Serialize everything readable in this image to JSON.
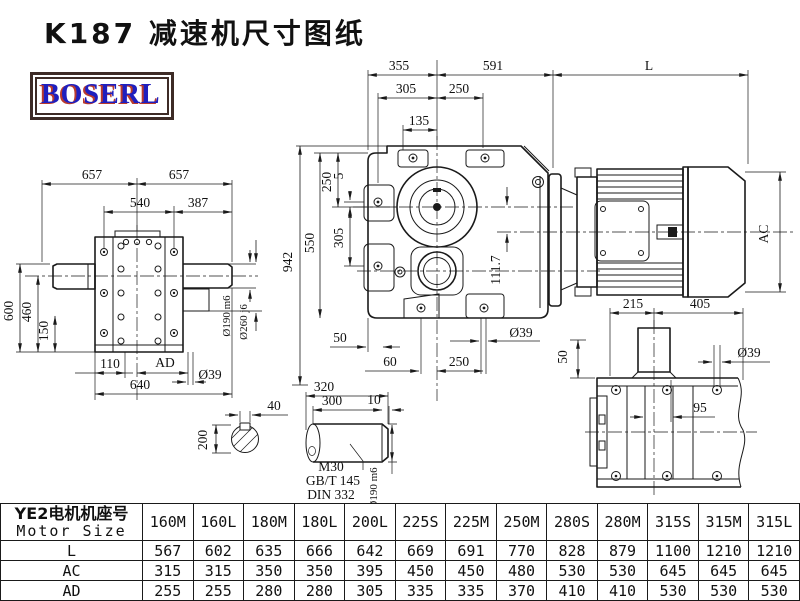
{
  "title": "K187 减速机尺寸图纸",
  "logo": {
    "text": "BOSERL"
  },
  "colors": {
    "line": "#1a1a1a",
    "logo_blue": "#1f1fbe",
    "logo_red": "#b93a2e",
    "logo_border": "#3d2b26"
  },
  "dims": {
    "t355": "355",
    "t591": "591",
    "tL": "L",
    "t305": "305",
    "t250": "250",
    "t135": "135",
    "v942": "942",
    "v550": "550",
    "v250": "250",
    "v5": "5",
    "v305": "305",
    "v1117": "111.7",
    "b50": "50",
    "b39": "Ø39",
    "b60": "60",
    "b250": "250",
    "r50": "50",
    "l657a": "657",
    "l657b": "657",
    "l540": "540",
    "l387": "387",
    "l600": "600",
    "l460": "460",
    "l150": "150",
    "l110": "110",
    "lAD": "AD",
    "l39": "Ø39",
    "l640": "640",
    "l190": "Ø190 m6",
    "l260": "Ø260 j6",
    "mAC": "AC",
    "p215": "215",
    "p405": "405",
    "p39": "Ø39",
    "p95": "95",
    "s40": "40",
    "s200": "200",
    "s320": "320",
    "s300": "300",
    "s10": "10",
    "sM30": "M30",
    "sGBT": "GB/T 145",
    "sDIN": "DIN 332",
    "s190": "Ø190 m6"
  },
  "table": {
    "header_cn": "YE2电机机座号",
    "header_en": "Motor Size",
    "columns": [
      "160M",
      "160L",
      "180M",
      "180L",
      "200L",
      "225S",
      "225M",
      "250M",
      "280S",
      "280M",
      "315S",
      "315M",
      "315L"
    ],
    "rows": [
      {
        "label": "L",
        "values": [
          "567",
          "602",
          "635",
          "666",
          "642",
          "669",
          "691",
          "770",
          "828",
          "879",
          "1100",
          "1210",
          "1210"
        ]
      },
      {
        "label": "AC",
        "values": [
          "315",
          "315",
          "350",
          "350",
          "395",
          "450",
          "450",
          "480",
          "530",
          "530",
          "645",
          "645",
          "645"
        ]
      },
      {
        "label": "AD",
        "values": [
          "255",
          "255",
          "280",
          "280",
          "305",
          "335",
          "335",
          "370",
          "410",
          "410",
          "530",
          "530",
          "530"
        ]
      }
    ]
  }
}
